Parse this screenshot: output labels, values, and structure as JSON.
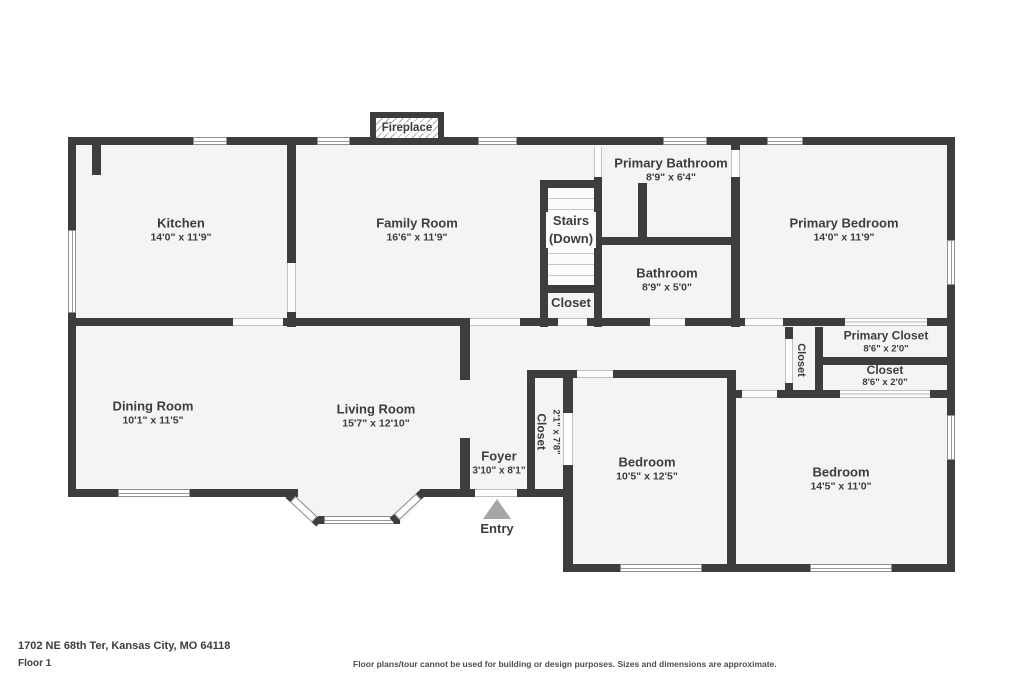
{
  "plan": {
    "fireplace_label": "Fireplace",
    "entry_label": "Entry",
    "rooms": {
      "kitchen": {
        "name": "Kitchen",
        "dims": "14'0\" x 11'9\""
      },
      "family_room": {
        "name": "Family Room",
        "dims": "16'6\" x 11'9\""
      },
      "stairs": {
        "name_line1": "Stairs",
        "name_line2": "(Down)"
      },
      "stairs_closet": {
        "name": "Closet"
      },
      "primary_bathroom": {
        "name": "Primary Bathroom",
        "dims": "8'9\" x 6'4\""
      },
      "bathroom": {
        "name": "Bathroom",
        "dims": "8'9\" x 5'0\""
      },
      "primary_bedroom": {
        "name": "Primary Bedroom",
        "dims": "14'0\" x 11'9\""
      },
      "primary_closet": {
        "name": "Primary Closet",
        "dims": "8'6\" x 2'0\""
      },
      "closet_right": {
        "name": "Closet",
        "dims": "8'6\" x 2'0\""
      },
      "hall_closet": {
        "name": "Closet"
      },
      "dining_room": {
        "name": "Dining Room",
        "dims": "10'1\" x 11'5\""
      },
      "living_room": {
        "name": "Living Room",
        "dims": "15'7\" x 12'10\""
      },
      "foyer": {
        "name": "Foyer",
        "dims": "3'10\" x 8'1\""
      },
      "entry_closet": {
        "name": "Closet",
        "dims": "2'1\" x 7'8\""
      },
      "bedroom_left": {
        "name": "Bedroom",
        "dims": "10'5\" x 12'5\""
      },
      "bedroom_right": {
        "name": "Bedroom",
        "dims": "14'5\" x 11'0\""
      }
    }
  },
  "footer": {
    "address": "1702 NE 68th Ter, Kansas City, MO 64118",
    "floor": "Floor 1",
    "disclaimer": "Floor plans/tour cannot be used for building or design purposes. Sizes and dimensions are approximate."
  },
  "colors": {
    "wall": "#3d3d3d",
    "room_fill": "#f4f4f4",
    "text": "#3d3d3d",
    "entry_arrow": "#a6a6a6"
  }
}
